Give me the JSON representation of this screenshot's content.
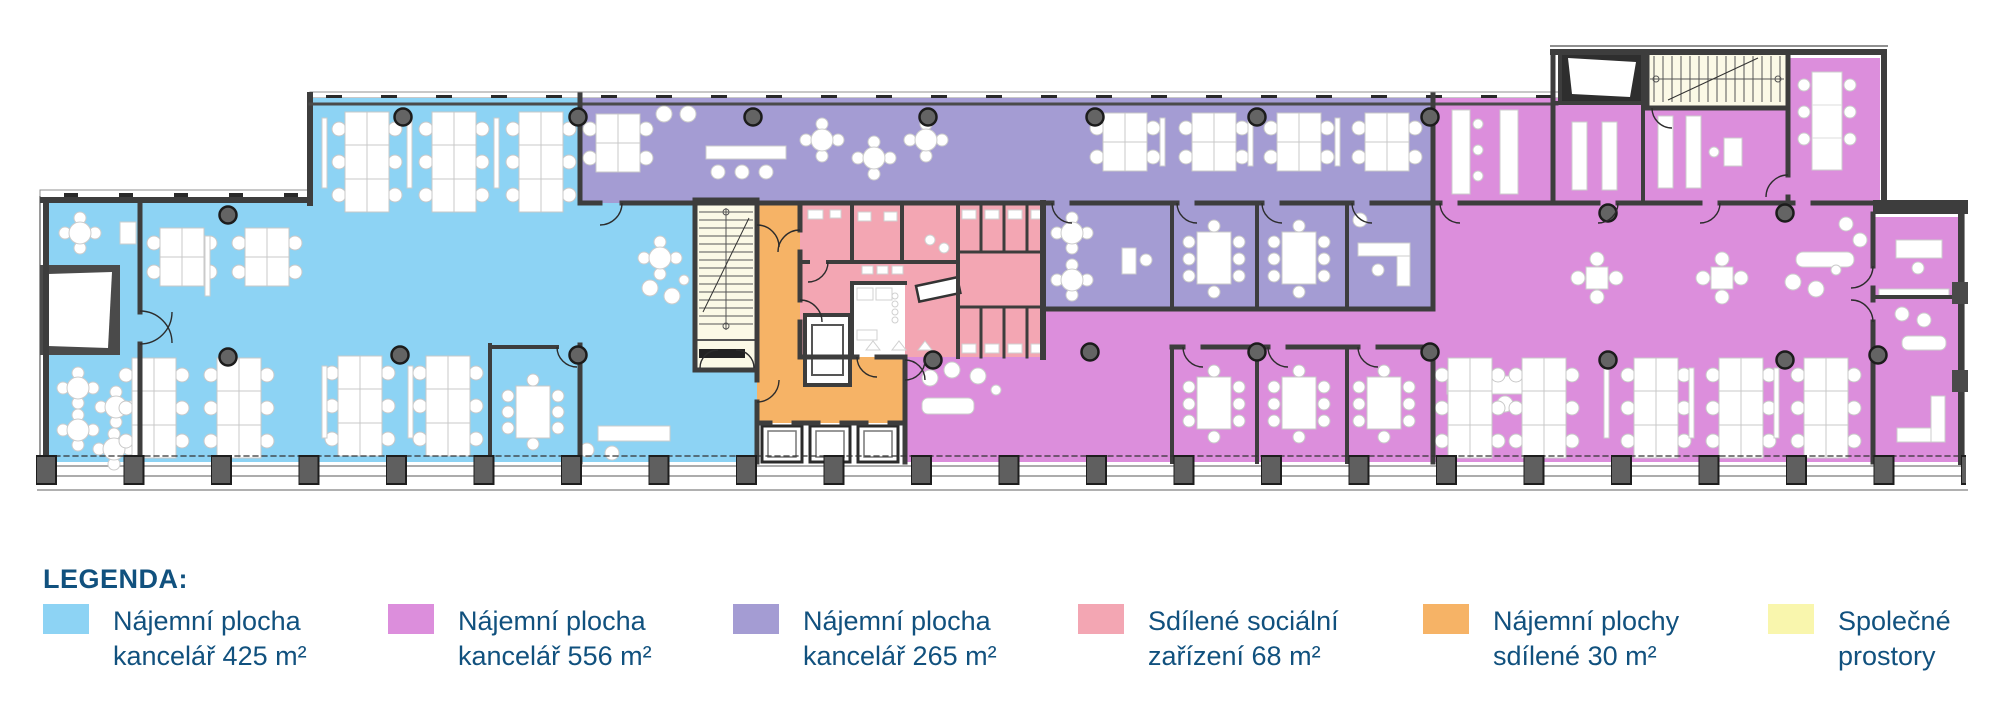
{
  "legend": {
    "title": "LEGENDA:",
    "text_color": "#11517E",
    "items": [
      {
        "id": "office-425",
        "color": "#8DD3F4",
        "line1": "Nájemní plocha",
        "line2": "kancelář 425 m²"
      },
      {
        "id": "office-556",
        "color": "#DC8EDC",
        "line1": "Nájemní plocha",
        "line2": "kancelář 556 m²"
      },
      {
        "id": "office-265",
        "color": "#A49CD3",
        "line1": "Nájemní plocha",
        "line2": "kancelář 265 m²"
      },
      {
        "id": "sanitary-68",
        "color": "#F3A6B3",
        "line1": "Sdílené sociální",
        "line2": "zařízení 68 m²"
      },
      {
        "id": "shared-30",
        "color": "#F6B366",
        "line1": "Nájemní plochy",
        "line2": "sdílené 30 m²"
      },
      {
        "id": "common",
        "color": "#F9F6AD",
        "line1": "Společné",
        "line2": "prostory"
      }
    ]
  },
  "plan": {
    "colors": {
      "office425": "#8DD3F4",
      "office556": "#DC8EDC",
      "office265": "#A49CD3",
      "sanitary": "#F3A6B3",
      "shared": "#F6B366",
      "common": "#FBF9E6",
      "wall": "#3d3d3d",
      "column": "#646464",
      "white": "#ffffff"
    }
  }
}
